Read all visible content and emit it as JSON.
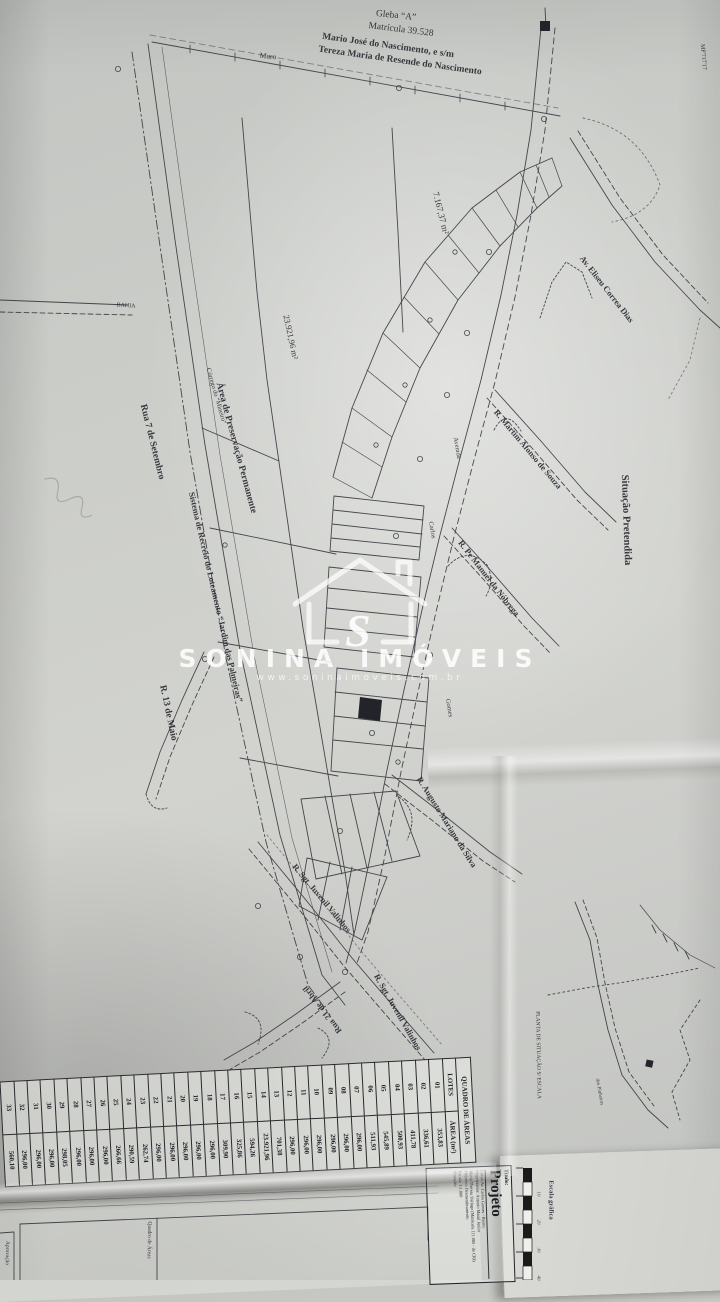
{
  "watermark": {
    "letter": "S",
    "brand": "SONINA IMÓVEIS",
    "url": "www.soninaimoveis.com.br"
  },
  "header": {
    "gleba": "Gleba “A”",
    "matricula": "Matrícula 39.528",
    "owner1": "Mario José do Nascimento, e s/m",
    "owner2": "Tereza Maria de Resende do Nascimento"
  },
  "map_labels": [
    {
      "name": "label-gleba",
      "text": "Gleba “A”",
      "x": 396,
      "y": 16,
      "rot": 6,
      "size": 9.5,
      "bold": false
    },
    {
      "name": "label-matricula",
      "text": "Matrícula 39.528",
      "x": 401,
      "y": 30,
      "rot": 7,
      "size": 9.5,
      "bold": false
    },
    {
      "name": "label-owner1",
      "text": "Mario José do Nascimento, e s/m",
      "x": 388,
      "y": 46,
      "rot": 8,
      "size": 9.5,
      "bold": true
    },
    {
      "name": "label-owner2",
      "text": "Tereza Maria de Resende do Nascimento",
      "x": 400,
      "y": 61,
      "rot": 8,
      "size": 9.5,
      "bold": true
    },
    {
      "name": "label-muro",
      "text": "Muro",
      "x": 268,
      "y": 56,
      "rot": 6,
      "size": 7.5,
      "bold": false
    },
    {
      "name": "label-corner-code",
      "text": "MP'717'17",
      "x": 703,
      "y": 57,
      "rot": 85,
      "size": 6,
      "bold": false
    },
    {
      "name": "label-area-7167",
      "text": "7.167,37 m²",
      "x": 441,
      "y": 213,
      "rot": 76,
      "size": 9,
      "bold": false
    },
    {
      "name": "label-av-eliseu",
      "text": "Av. Eliseu Correa Dias",
      "x": 607,
      "y": 289,
      "rot": 52,
      "size": 8.5,
      "bold": true
    },
    {
      "name": "label-r-martim",
      "text": "R. Martim Afonso de Souza",
      "x": 528,
      "y": 449,
      "rot": 50,
      "size": 8.5,
      "bold": true
    },
    {
      "name": "label-situacao-pretendida",
      "text": "Situação Pretendida",
      "x": 626,
      "y": 520,
      "rot": 88,
      "size": 10.5,
      "bold": true
    },
    {
      "name": "label-bahia",
      "text": "BAHIA",
      "x": 126,
      "y": 306,
      "rot": 4,
      "size": 6,
      "bold": false
    },
    {
      "name": "label-corrego",
      "text": "Córrego do “Mineiro”",
      "x": 216,
      "y": 396,
      "rot": 74,
      "size": 6.5,
      "bold": false
    },
    {
      "name": "label-preservacao",
      "text": "Área de Preservação Permanente",
      "x": 236,
      "y": 448,
      "rot": 75,
      "size": 9.5,
      "bold": true
    },
    {
      "name": "label-area-23921",
      "text": "23.921,96 m²",
      "x": 291,
      "y": 337,
      "rot": 78,
      "size": 8.5,
      "bold": false
    },
    {
      "name": "label-rua7",
      "text": "Rua 7 de Setembro",
      "x": 152,
      "y": 442,
      "rot": 76,
      "size": 9.5,
      "bold": true
    },
    {
      "name": "label-sistema-recreio",
      "text": "Sistema de Recreio do Loteamento “Jardim das Palmeiras”",
      "x": 216,
      "y": 597,
      "rot": 77,
      "size": 8.5,
      "bold": true
    },
    {
      "name": "label-r13-maio",
      "text": "R. 13 de Maio",
      "x": 168,
      "y": 713,
      "rot": 78,
      "size": 9.5,
      "bold": true
    },
    {
      "name": "label-avenida",
      "text": "Avenida",
      "x": 457,
      "y": 448,
      "rot": 80,
      "size": 6.5,
      "bold": false
    },
    {
      "name": "label-carlos",
      "text": "Carlos",
      "x": 432,
      "y": 530,
      "rot": 80,
      "size": 6.5,
      "bold": false
    },
    {
      "name": "label-gomes",
      "text": "Gomes",
      "x": 449,
      "y": 708,
      "rot": 80,
      "size": 6.5,
      "bold": false
    },
    {
      "name": "label-r-nobrega",
      "text": "R. Pe Manuel da Nóbrega",
      "x": 489,
      "y": 578,
      "rot": 52,
      "size": 8.5,
      "bold": true
    },
    {
      "name": "label-r-augusto",
      "text": "R. Augusto Mariano da Silva",
      "x": 447,
      "y": 822,
      "rot": 58,
      "size": 8.5,
      "bold": true
    },
    {
      "name": "label-r-sgt-1",
      "text": "R. Sgt. Juvenil Valinhos",
      "x": 322,
      "y": 898,
      "rot": 50,
      "size": 8.5,
      "bold": true
    },
    {
      "name": "label-r-sgt-2",
      "text": "R. Sgt. Juvenil Valinhos",
      "x": 398,
      "y": 1012,
      "rot": 60,
      "size": 8.5,
      "bold": true
    },
    {
      "name": "label-rua21-abril",
      "text": "Rua 21 de Abril",
      "x": 322,
      "y": 1010,
      "rot": 232,
      "size": 8.5,
      "bold": true
    },
    {
      "name": "label-planta-situacao",
      "text": "PLANTA DE SITUAÇÃO S/ ESCALA",
      "x": 538,
      "y": 1055,
      "rot": 89,
      "size": 5.5,
      "bold": false
    },
    {
      "name": "label-pinheiros",
      "text": "dos Pinheiros",
      "x": 599,
      "y": 1092,
      "rot": 80,
      "size": 5,
      "bold": false
    },
    {
      "name": "label-escala-grafica",
      "text": "Escala gráfica",
      "x": 551,
      "y": 1200,
      "rot": 90,
      "size": 6.5,
      "bold": true
    },
    {
      "name": "label-quadro-areas-box",
      "text": "Quadro de Áreas",
      "x": 149,
      "y": 1240,
      "rot": 91,
      "size": 5.5,
      "bold": false
    },
    {
      "name": "label-aprovacao-box",
      "text": "Aprovação",
      "x": 7,
      "y": 1253,
      "rot": 91,
      "size": 5.5,
      "bold": false
    }
  ],
  "scale_bar": {
    "label": "Escala gráfica",
    "ticks": [
      "10",
      "20",
      "30",
      "40"
    ]
  },
  "area_table": {
    "title": "QUADRO DE ÁREAS",
    "columns": [
      "LOTES",
      "ÁREA (m²)"
    ],
    "rows": [
      [
        "01",
        "353,83"
      ],
      [
        "02",
        "336,61"
      ],
      [
        "03",
        "411,78"
      ],
      [
        "04",
        "500,93"
      ],
      [
        "05",
        "545,89"
      ],
      [
        "06",
        "511,93"
      ],
      [
        "07",
        "296,00"
      ],
      [
        "08",
        "296,00"
      ],
      [
        "09",
        "296,00"
      ],
      [
        "10",
        "296,00"
      ],
      [
        "11",
        "296,00"
      ],
      [
        "12",
        "296,00"
      ],
      [
        "13",
        "701,38"
      ],
      [
        "14",
        "23.921,96"
      ],
      [
        "15",
        "594,26"
      ],
      [
        "16",
        "325,86"
      ],
      [
        "17",
        "309,90"
      ],
      [
        "18",
        "296,00"
      ],
      [
        "19",
        "296,00"
      ],
      [
        "20",
        "296,00"
      ],
      [
        "21",
        "296,00"
      ],
      [
        "22",
        "296,00"
      ],
      [
        "23",
        "262,74"
      ],
      [
        "24",
        "290,59"
      ],
      [
        "25",
        "266,66"
      ],
      [
        "26",
        "296,00"
      ],
      [
        "27",
        "296,00"
      ],
      [
        "28",
        "296,00"
      ],
      [
        "29",
        "298,05"
      ],
      [
        "30",
        "296,00"
      ],
      [
        "31",
        "296,00"
      ],
      [
        "32",
        "296,00"
      ],
      [
        "33",
        "560,10"
      ]
    ]
  },
  "title_block": {
    "titulo_label": "Título:",
    "titulo": "Projeto",
    "lines": [
      "Local: Av. Carlos Gomes - Bairro",
      "Proprietários: Antonio Masul Junior",
      "Maria Theresa Dallugo (Matrícula 111.085 - do CRI)",
      "Objetivo: Desmembramento",
      "Escala: 1:1.000",
      "Situação:"
    ]
  }
}
